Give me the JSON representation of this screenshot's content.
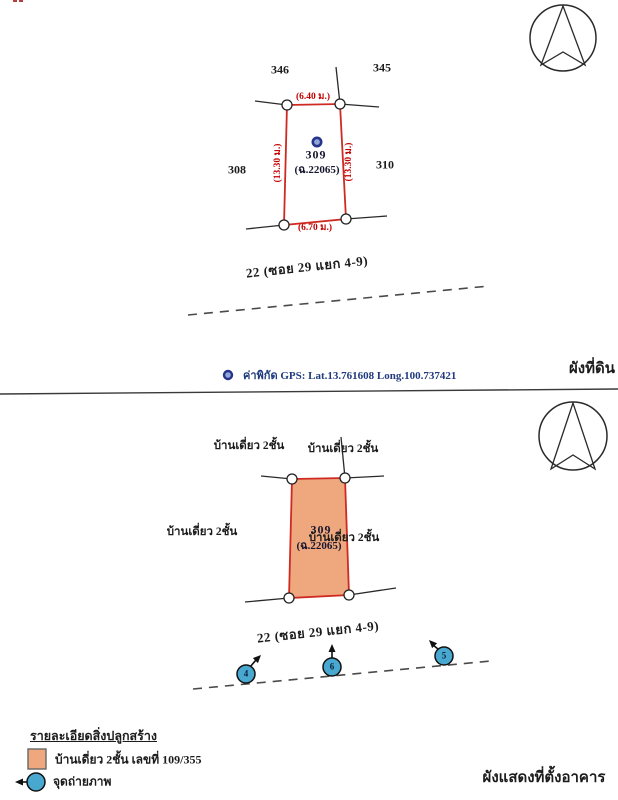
{
  "colors": {
    "plot_line": "#cf2a22",
    "dimension_text": "#c00000",
    "building_fill": "#efa87e",
    "photo_circle": "#49a8cf",
    "gps_text": "#203a7d",
    "ink": "#1b1b1b"
  },
  "top_panel": {
    "title": "ผังที่ดิน",
    "neighbors": {
      "top_left": "346",
      "top_right": "345",
      "left": "308",
      "right": "310"
    },
    "plot": {
      "number": "309",
      "deed": "(ฉ.22065)"
    },
    "dimensions": {
      "top": "(6.40 ม.)",
      "bottom": "(6.70 ม.)",
      "left": "(13.30 ม.)",
      "right": "(13.30 ม.)"
    },
    "road": "22 (ซอย 29 แยก 4-9)",
    "gps": "ค่าพิกัด GPS:  Lat.13.761608 Long.100.737421"
  },
  "bottom_panel": {
    "title": "ผังแสดงที่ตั้งอาคาร",
    "plot": {
      "number": "309",
      "deed": "(ฉ.22065)"
    },
    "surroundings": {
      "top_left": "บ้านเดี่ยว 2ชั้น",
      "top_right": "บ้านเดี่ยว 2ชั้น",
      "left": "บ้านเดี่ยว 2ชั้น",
      "right": "บ้านเดี่ยว 2ชั้น"
    },
    "road": "22 (ซอย 29 แยก 4-9)",
    "photo_points": [
      "4",
      "6",
      "5"
    ],
    "legend": {
      "header": "รายละเอียดสิ่งปลูกสร้าง",
      "building": "บ้านเดี่ยว 2ชั้น เลขที่ 109/355",
      "photo": "จุดถ่ายภาพ"
    }
  }
}
